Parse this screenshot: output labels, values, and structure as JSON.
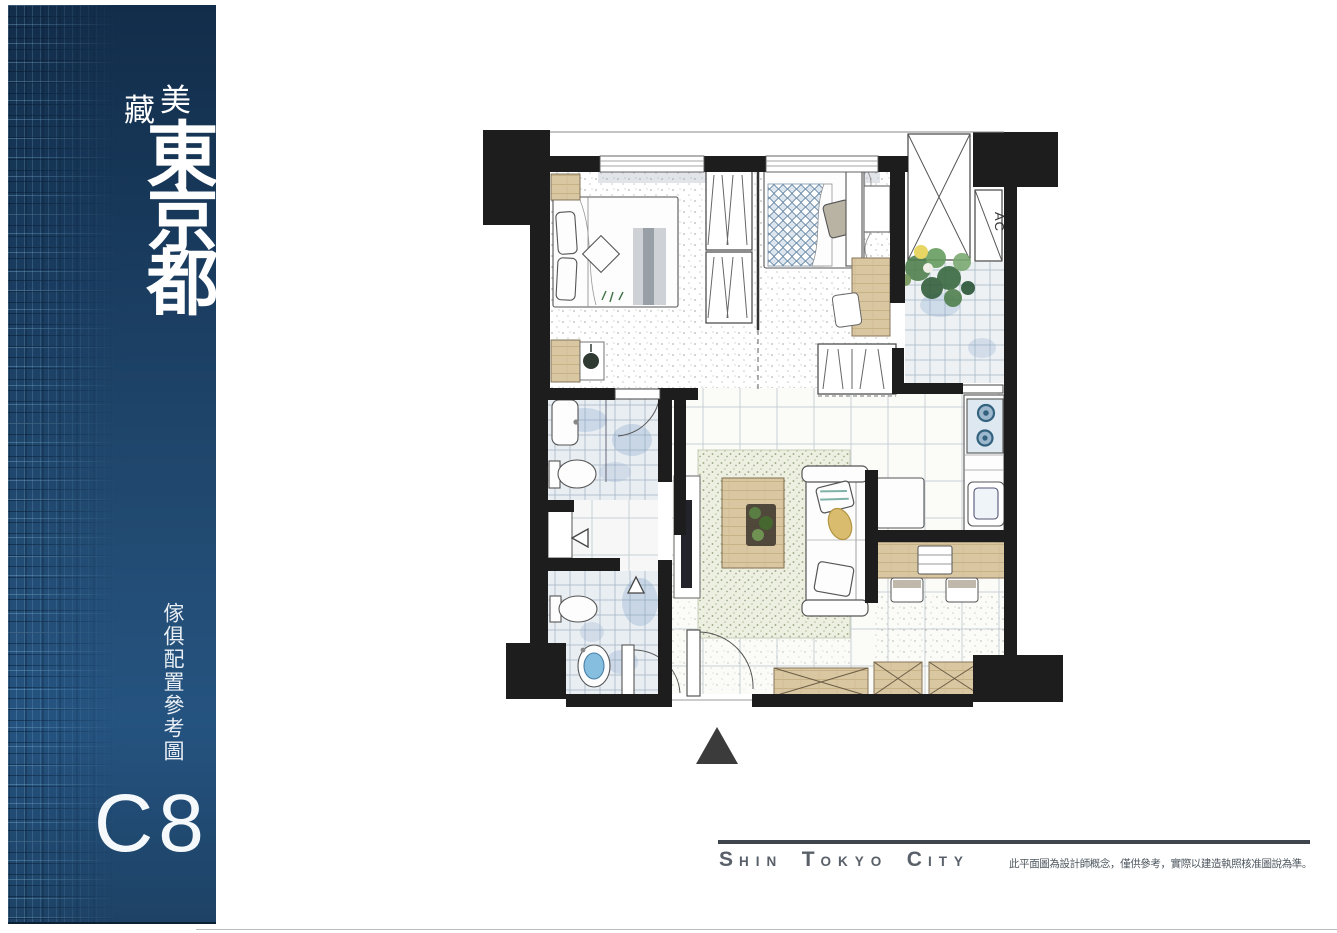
{
  "sidebar": {
    "tagline": [
      "藏",
      "美"
    ],
    "project_name": "東京都",
    "caption": "傢俱配置參考圖",
    "unit_label": "C8",
    "colors": {
      "banner_top": "#122d4a",
      "banner_middle": "#224b72",
      "banner_bottom": "#1d4265",
      "brick_highlight": "#89bddc",
      "text": "#ffffff"
    }
  },
  "floor_plan": {
    "ac_label": "AC",
    "entrance_marker": "up-triangle",
    "colors": {
      "wall": "#1d1d1d",
      "ink": "#4a4a4a",
      "wood": "#d9c7a2",
      "tile_line": "#a9b7c4",
      "rug": "#edf0e0",
      "plant_green": "#4c7d4a",
      "water_blue": "#85bede",
      "burner_blue": "#33627f"
    }
  },
  "footer": {
    "brand": [
      {
        "initial": "S",
        "rest": "HIN"
      },
      {
        "initial": "T",
        "rest": "OKYO"
      },
      {
        "initial": "C",
        "rest": "ITY"
      }
    ],
    "disclaimer": "此平面圖為設計師概念，僅供參考，實際以建造執照核准圖說為準。",
    "rule_color": "#3f454c"
  }
}
